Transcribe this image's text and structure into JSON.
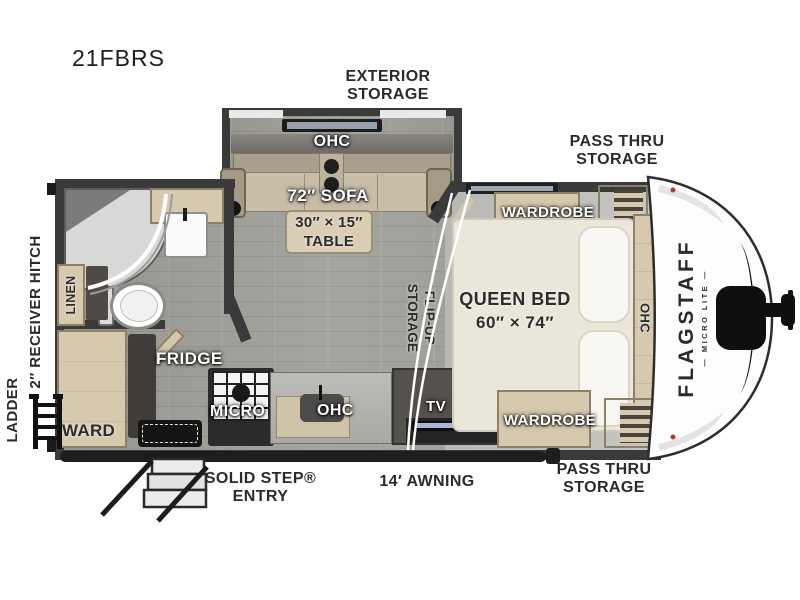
{
  "palette": {
    "wall": "#3a3a3a",
    "floor_wood": "#9e9e9a",
    "cabinet_wood": "#d6c9ae",
    "mattress": "#eae6da",
    "label_dark": "#2d2d2d",
    "label_white": "#ffffff",
    "marker_light": "#b03a2e",
    "awning_bar": "#1d1d1d",
    "front_cap": "#fdfdfd"
  },
  "model": "21FBRS",
  "brand": {
    "name": "FLAGSTAFF",
    "series": "MICRO LITE"
  },
  "exterior": {
    "exterior_storage": [
      "EXTERIOR",
      "STORAGE"
    ],
    "pass_thru_top": [
      "PASS THRU",
      "STORAGE"
    ],
    "pass_thru_bottom": [
      "PASS THRU",
      "STORAGE"
    ],
    "solid_step_entry": [
      "SOLID STEP®",
      "ENTRY"
    ],
    "awning": "14′ AWNING",
    "receiver_hitch": "2″ RECEIVER HITCH",
    "ladder": "LADDER"
  },
  "interior": {
    "slide_ohc": "OHC",
    "sofa": "72″ SOFA",
    "table": [
      "30″ × 15″",
      "TABLE"
    ],
    "flip_up_storage": [
      "FLIP-UP",
      "STORAGE"
    ],
    "wardrobe_top": "WARDROBE",
    "wardrobe_bottom": "WARDROBE",
    "queen_bed": [
      "QUEEN BED",
      "60″ × 74″"
    ],
    "bed_ohc": "OHC",
    "linen": "LINEN",
    "ward": "WARD",
    "fridge": "FRIDGE",
    "micro": "MICRO",
    "kitchen_ohc": "OHC",
    "tv": "TV"
  }
}
